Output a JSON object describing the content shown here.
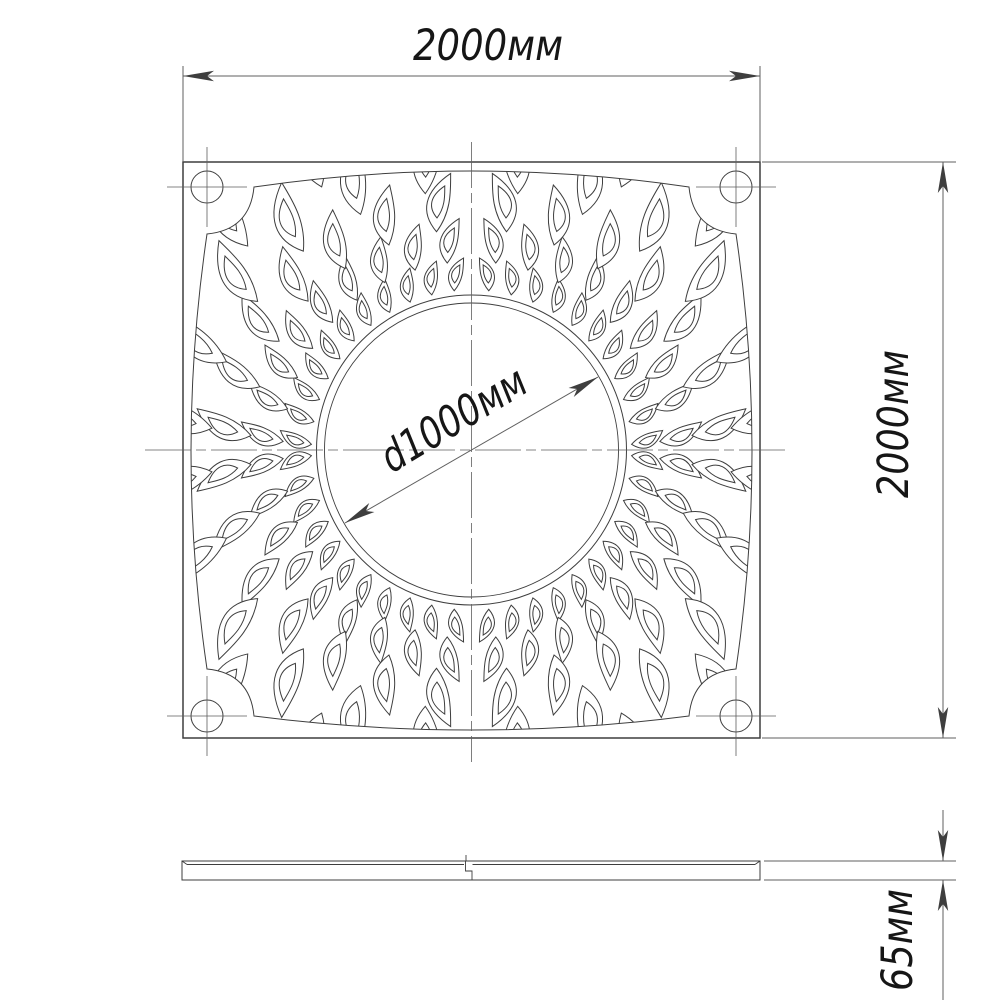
{
  "labels": {
    "top_width": "2000мм",
    "side_height": "2000мм",
    "inner_diameter": "d1000мм",
    "thickness": "65мм"
  },
  "colors": {
    "line": "#3e3e3e",
    "dim_line": "#5f5f5f",
    "text": "#161616",
    "background": "#ffffff"
  }
}
